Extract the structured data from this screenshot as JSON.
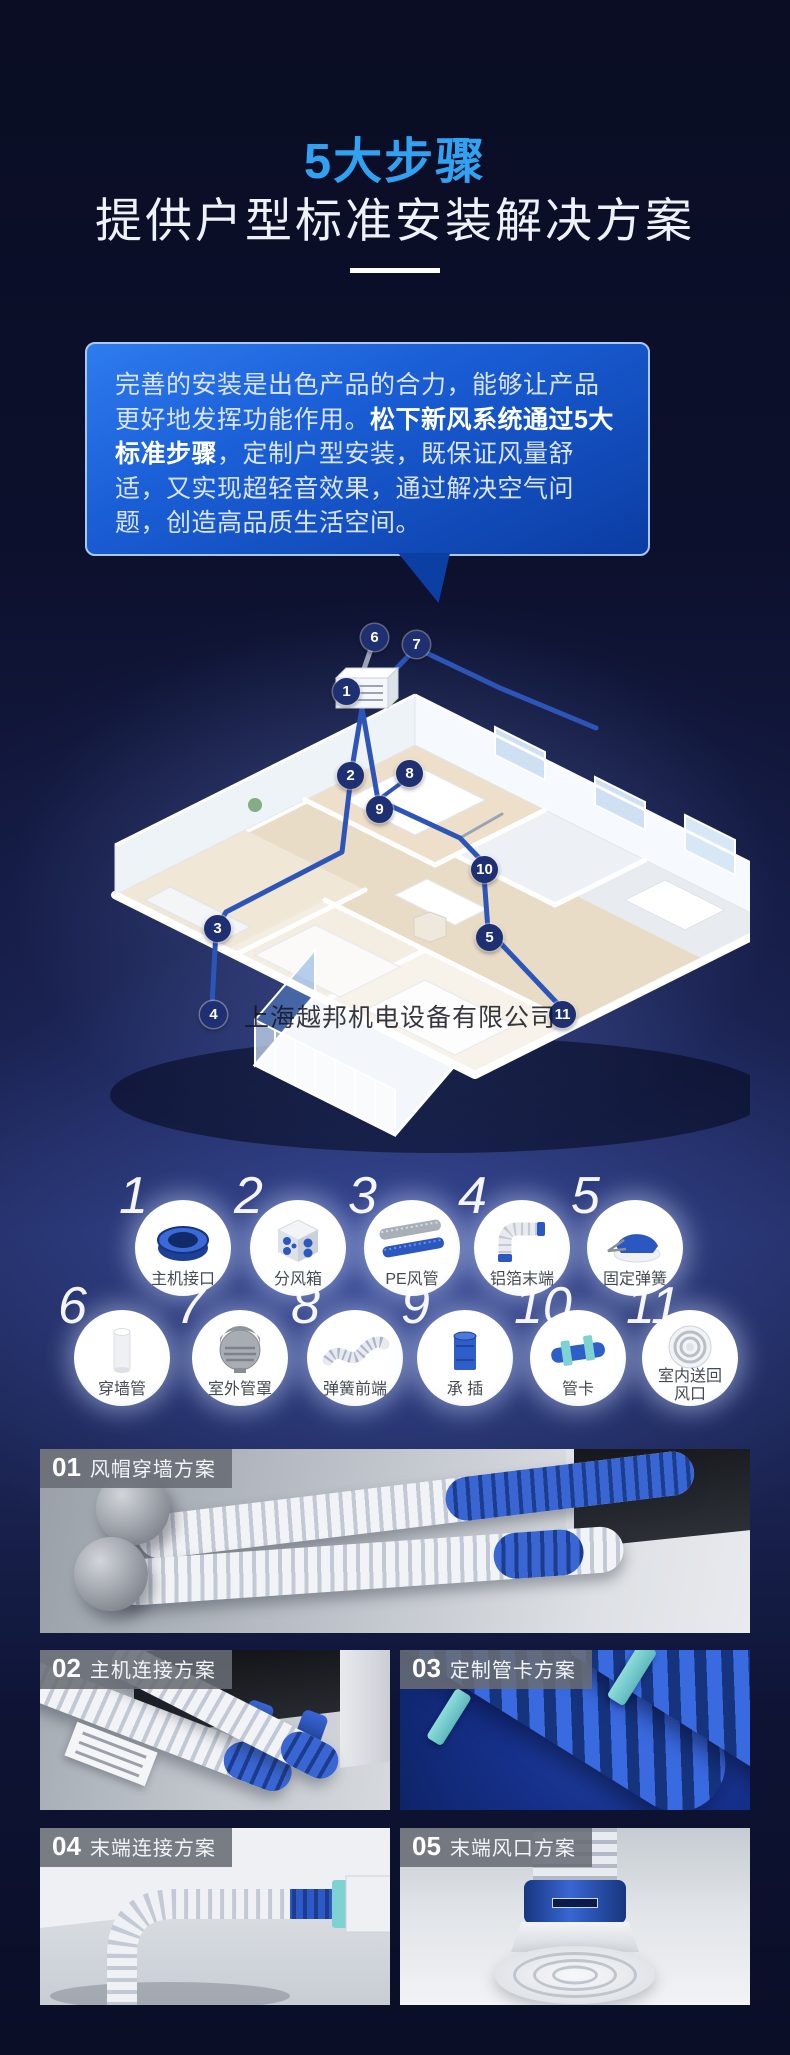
{
  "header": {
    "title": "5大步骤",
    "subtitle": "提供户型标准安装解决方案"
  },
  "intro": {
    "run1": "完善的安装是出色产品的合力，能够让产品更好地发挥功能作用。",
    "run2": "松下新风系统通过5大标准步骤",
    "run3": "，定制户型安装，既保证风量舒适，又实现超轻音效果，通过解决空气问题，创造高品质生活空间。"
  },
  "floorplan": {
    "watermark": "上海越邦机电设备有限公司",
    "markers": [
      {
        "number": "1"
      },
      {
        "number": "2"
      },
      {
        "number": "3"
      },
      {
        "number": "4"
      },
      {
        "number": "5"
      },
      {
        "number": "6"
      },
      {
        "number": "7"
      },
      {
        "number": "8"
      },
      {
        "number": "9"
      },
      {
        "number": "10"
      },
      {
        "number": "11"
      }
    ]
  },
  "products": {
    "items": [
      {
        "number": "1",
        "label": "主机接口"
      },
      {
        "number": "2",
        "label": "分风箱"
      },
      {
        "number": "3",
        "label": "PE风管"
      },
      {
        "number": "4",
        "label": "铝箔末端"
      },
      {
        "number": "5",
        "label": "固定弹簧"
      },
      {
        "number": "6",
        "label": "穿墙管"
      },
      {
        "number": "7",
        "label": "室外管罩"
      },
      {
        "number": "8",
        "label": "弹簧前端"
      },
      {
        "number": "9",
        "label": "承 插"
      },
      {
        "number": "10",
        "label": "管卡"
      },
      {
        "number": "11",
        "label": "室内送回风口"
      }
    ]
  },
  "sections": [
    {
      "number": "01",
      "title": "风帽穿墙方案"
    },
    {
      "number": "02",
      "title": "主机连接方案"
    },
    {
      "number": "03",
      "title": "定制管卡方案"
    },
    {
      "number": "04",
      "title": "末端连接方案"
    },
    {
      "number": "05",
      "title": "末端风口方案"
    }
  ],
  "colors": {
    "accent_blue": "#31a1f1",
    "bubble_blue": "#1a5ed6",
    "marker_navy": "#1e2f72",
    "duct_blue": "#2d55b8",
    "clamp_teal": "#7ed2d2"
  }
}
